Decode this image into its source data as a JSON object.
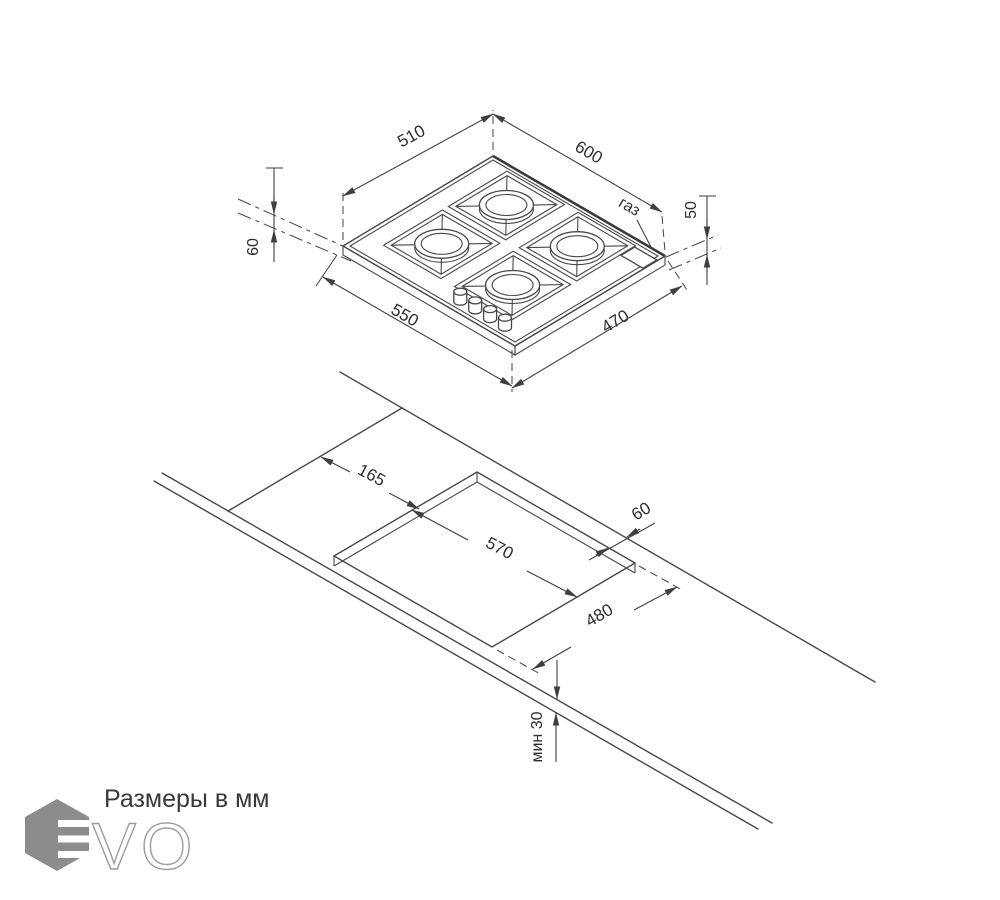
{
  "caption": "Размеры в мм",
  "colors": {
    "line": "#484848",
    "text": "#2d2d2d",
    "logo_hexagon": "#8c8c8c",
    "logo_outline": "#9c9c9c"
  },
  "hob_view": {
    "top_left_edge_mm": "510",
    "top_right_edge_mm": "600",
    "front_left_edge_mm": "550",
    "front_right_edge_mm": "470",
    "left_height_mm": "60",
    "right_height_mm": "50",
    "gas_label": "газ"
  },
  "cutout_view": {
    "left_offset_mm": "165",
    "rear_gap_mm": "60",
    "cutout_length_mm": "570",
    "cutout_depth_mm": "480",
    "min_worktop_thickness": "мин 30"
  },
  "logo": {
    "letters": "VO"
  }
}
